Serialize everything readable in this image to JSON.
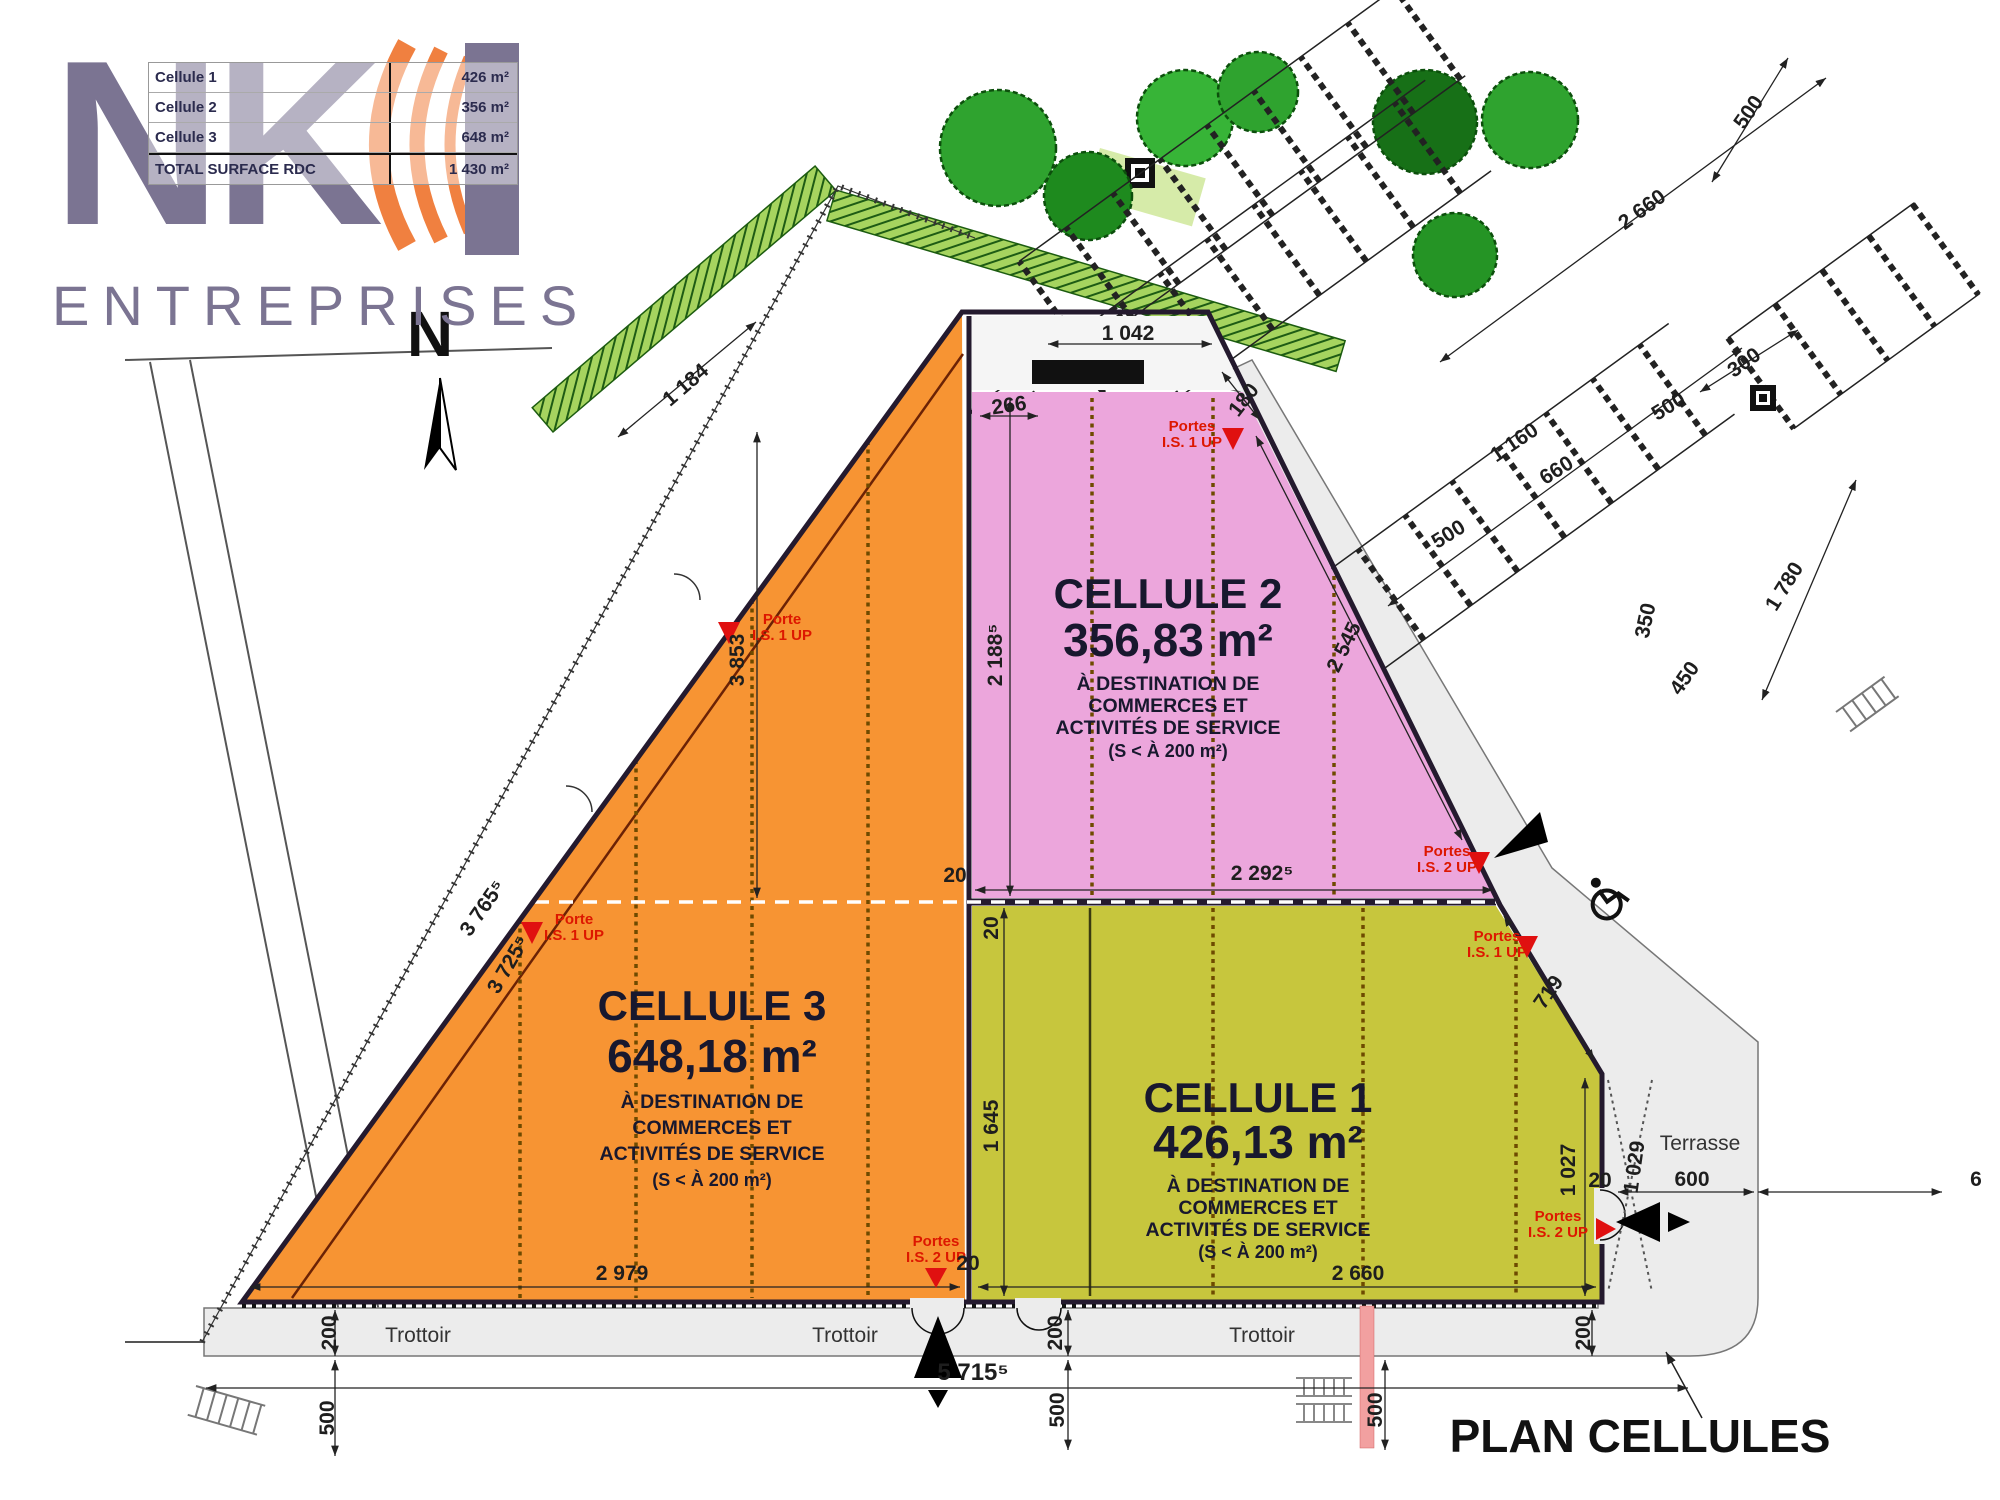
{
  "logo": {
    "n": "N",
    "k": "K",
    "i": "I",
    "subtitle": "ENTREPRISES"
  },
  "legend": {
    "rows": [
      {
        "label": "Cellule 1",
        "value": "426 m²"
      },
      {
        "label": "Cellule 2",
        "value": "356 m²"
      },
      {
        "label": "Cellule 3",
        "value": "648 m²"
      }
    ],
    "total": {
      "label": "TOTAL SURFACE RDC",
      "value": "1 430 m²"
    }
  },
  "north": {
    "label": "N"
  },
  "title": {
    "text": "PLAN CELLULES"
  },
  "streets": {
    "trottoir": [
      "Trottoir",
      "Trottoir",
      "Trottoir"
    ],
    "terrasse": "Terrasse"
  },
  "cells": {
    "c1": {
      "title": "CELLULE 1",
      "area": "426,13 m²",
      "dest1": "À DESTINATION DE",
      "dest2": "COMMERCES ET",
      "dest3": "ACTIVITÉS DE SERVICE",
      "note": "(S < À 200 m²)"
    },
    "c2": {
      "title": "CELLULE 2",
      "area": "356,83 m²",
      "dest1": "À DESTINATION DE",
      "dest2": "COMMERCES ET",
      "dest3": "ACTIVITÉS DE SERVICE",
      "note": "(S < À 200 m²)"
    },
    "c3": {
      "title": "CELLULE 3",
      "area": "648,18 m²",
      "dest1": "À DESTINATION DE",
      "dest2": "COMMERCES ET",
      "dest3": "ACTIVITÉS DE SERVICE",
      "note": "(S < À 200 m²)"
    }
  },
  "doors": [
    {
      "l1": "Portes",
      "l2": "I.S. 1 UP"
    },
    {
      "l1": "Porte",
      "l2": "I.S. 1 UP"
    },
    {
      "l1": "Porte",
      "l2": "I.S. 1 UP"
    },
    {
      "l1": "Portes",
      "l2": "I.S. 2 UP"
    },
    {
      "l1": "Portes",
      "l2": "I.S. 1 UP"
    },
    {
      "l1": "Portes",
      "l2": "I.S. 2 UP"
    },
    {
      "l1": "Portes",
      "l2": "I.S. 2 UP"
    }
  ],
  "dims": [
    {
      "v": "1 042"
    },
    {
      "v": "266"
    },
    {
      "v": "180"
    },
    {
      "v": "2 188⁵"
    },
    {
      "v": "2 545"
    },
    {
      "v": "1 184"
    },
    {
      "v": "3 853"
    },
    {
      "v": "3 765⁵"
    },
    {
      "v": "3 725⁵"
    },
    {
      "v": "20"
    },
    {
      "v": "20"
    },
    {
      "v": "2 292⁵"
    },
    {
      "v": "1 645"
    },
    {
      "v": "2 979"
    },
    {
      "v": "20"
    },
    {
      "v": "2 660"
    },
    {
      "v": "719"
    },
    {
      "v": "1 027"
    },
    {
      "v": "20"
    },
    {
      "v": "1 029"
    },
    {
      "v": "600"
    },
    {
      "v": "6"
    },
    {
      "v": "200"
    },
    {
      "v": "500"
    },
    {
      "v": "200"
    },
    {
      "v": "500"
    },
    {
      "v": "500"
    },
    {
      "v": "200"
    },
    {
      "v": "500"
    },
    {
      "v": "2 660"
    },
    {
      "v": "300"
    },
    {
      "v": "500"
    },
    {
      "v": "660"
    },
    {
      "v": "500"
    },
    {
      "v": "1 780"
    },
    {
      "v": "350"
    },
    {
      "v": "450"
    },
    {
      "v": "1 160"
    }
  ],
  "colors": {
    "cell1_olive": "#C7C63D",
    "cell2_pink": "#ECA6DC",
    "cell3_orange": "#F79433",
    "logo_purple": "#7B7492",
    "logo_orange": "#F08040",
    "door_red": "#DD1700",
    "hedge_green": "#A6D45F",
    "tree_green": "#2FA32F",
    "apron_gray": "#ECECEC"
  }
}
